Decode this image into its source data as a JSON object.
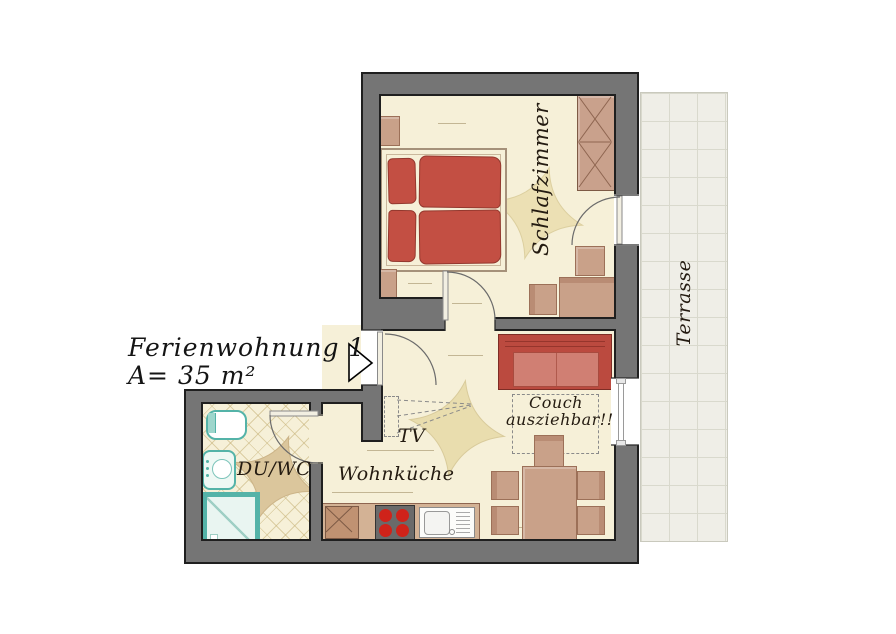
{
  "title": {
    "line1": "Ferienwohnung 1",
    "line2": "A= 35 m²"
  },
  "rooms": {
    "bedroom": {
      "label": "Schlafzimmer"
    },
    "living_kitchen": {
      "label": "Wohnküche"
    },
    "bath": {
      "label": "DU/WC"
    },
    "terrace": {
      "label": "Terrasse"
    }
  },
  "annotations": {
    "tv": "TV",
    "couch_line1": "Couch",
    "couch_line2": "ausziehbar!!"
  },
  "colors": {
    "wall_gray": "#757575",
    "floor_cream": "#f6f0d8",
    "bed_red": "#c34f43",
    "couch_red": "#bb4a3f",
    "furniture_tan": "#c9a189",
    "fixture_teal": "#54b3a8",
    "terrace_gray": "#efeee7"
  }
}
